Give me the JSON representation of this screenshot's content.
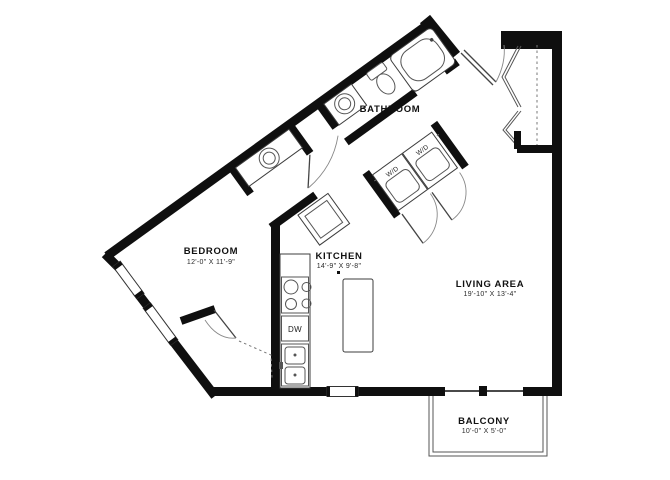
{
  "plan": {
    "rooms": {
      "bedroom": {
        "name": "BEDROOM",
        "dims": "12'-0\" X 11'-9\""
      },
      "bathroom": {
        "name": "BATHROOM"
      },
      "kitchen": {
        "name": "KITCHEN",
        "dims": "14'-9\" X 9'-8\""
      },
      "living": {
        "name": "LIVING AREA",
        "dims": "19'-10\" X 13'-4\""
      },
      "balcony": {
        "name": "BALCONY",
        "dims": "10'-0\" X 5'-0\""
      }
    },
    "labels": {
      "washer_dryer": "W/D",
      "dishwasher": "DW"
    },
    "colors": {
      "wall": "#0f0f0f",
      "line": "#3c3c3c",
      "background": "#ffffff",
      "text": "#1a1a1a"
    }
  }
}
